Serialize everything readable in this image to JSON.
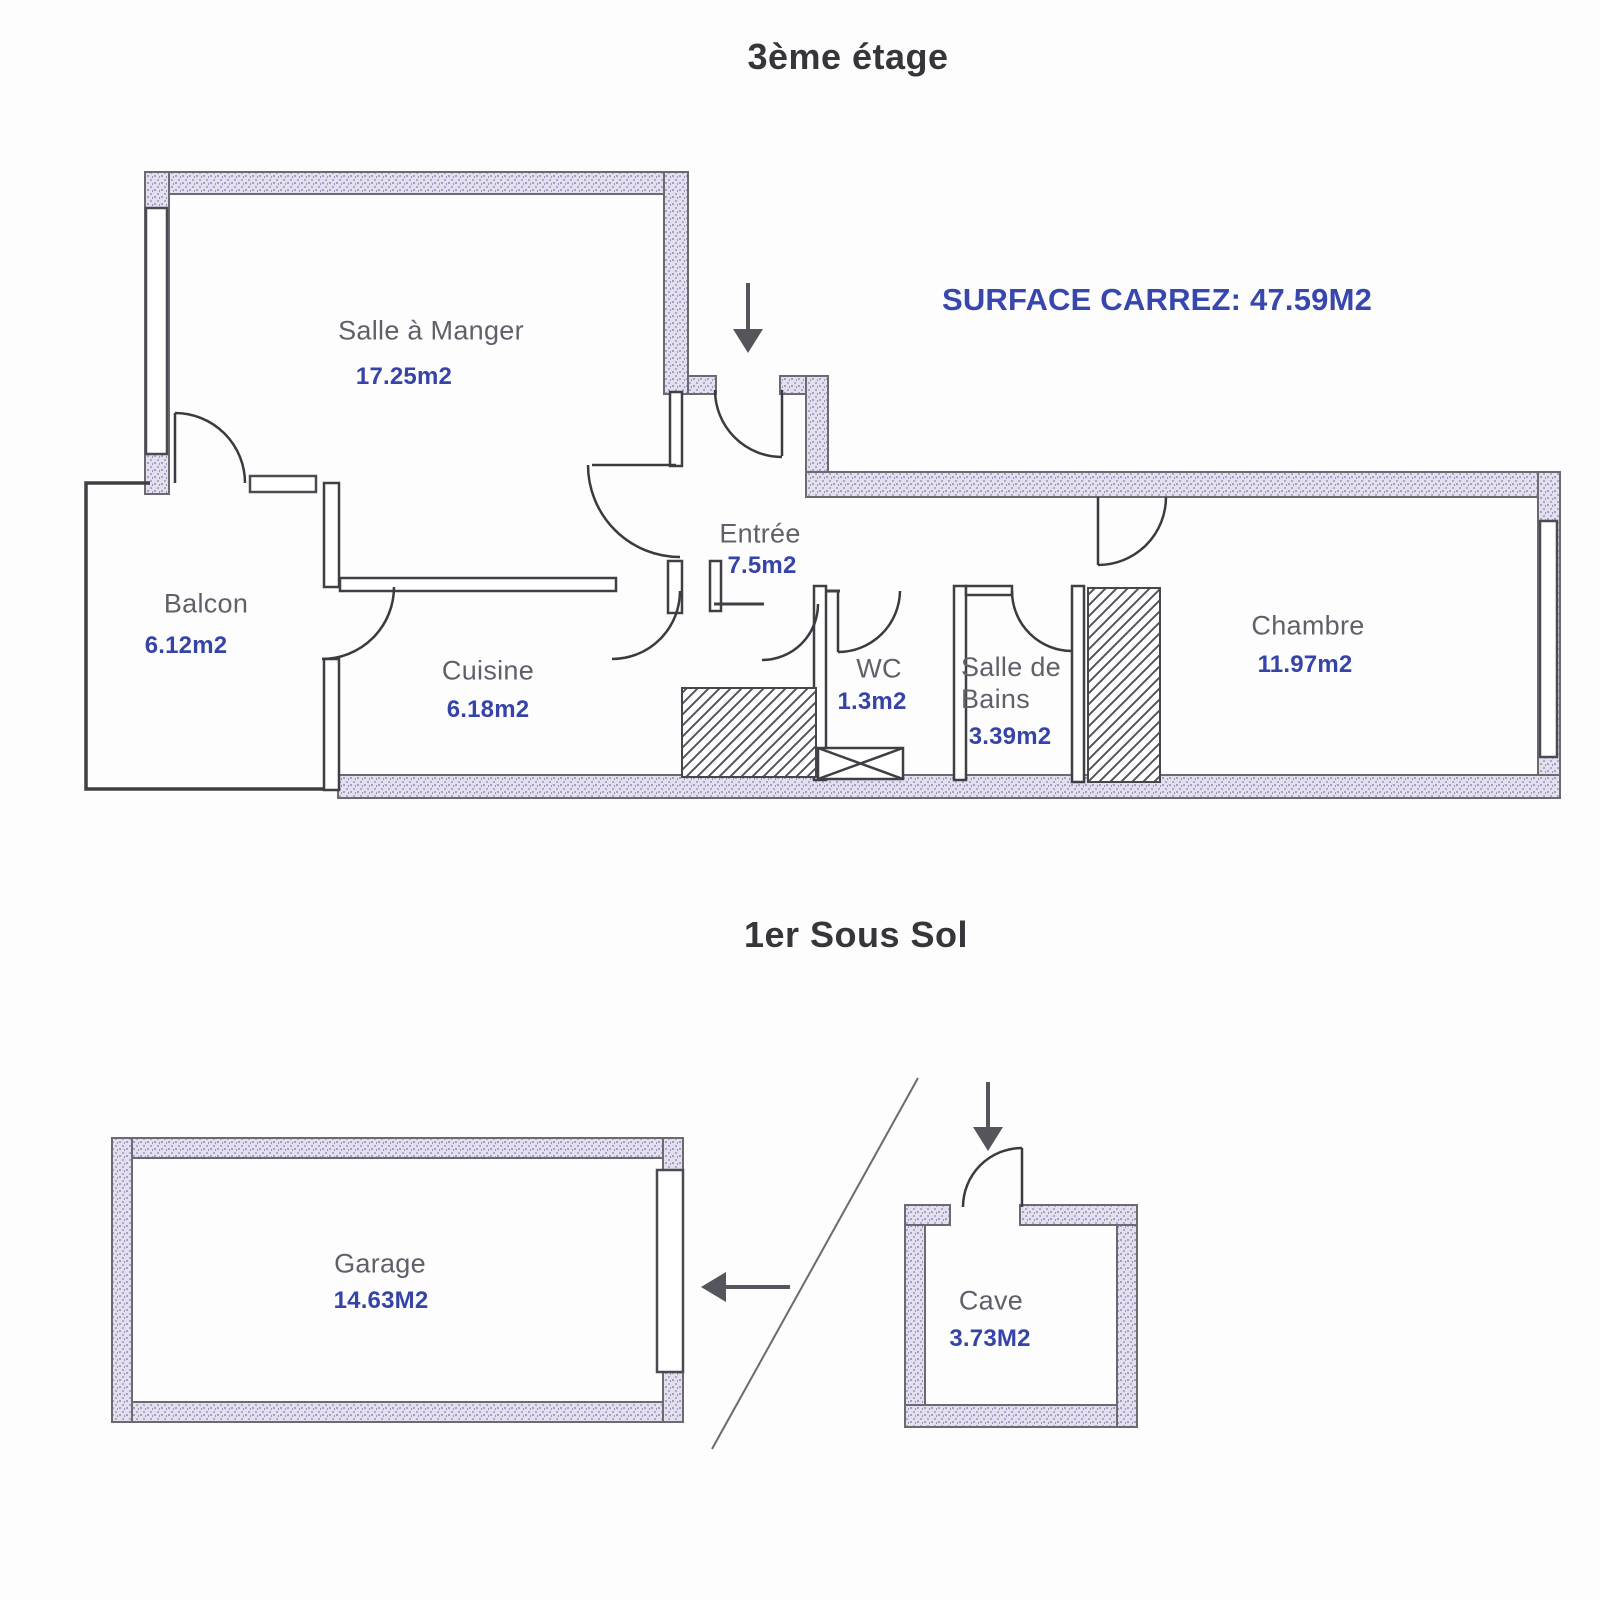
{
  "floor3": {
    "title": "3ème étage",
    "surface_note": "SURFACE CARREZ: 47.59M2",
    "rooms": [
      {
        "id": "salle-a-manger",
        "name": "Salle à Manger",
        "area": "17.25m2"
      },
      {
        "id": "balcon",
        "name": "Balcon",
        "area": "6.12m2"
      },
      {
        "id": "cuisine",
        "name": "Cuisine",
        "area": "6.18m2"
      },
      {
        "id": "entree",
        "name": "Entrée",
        "area": "7.5m2"
      },
      {
        "id": "wc",
        "name": "WC",
        "area": "1.3m2"
      },
      {
        "id": "salle-de-bains",
        "name": "Salle de Bains",
        "area": "3.39m2"
      },
      {
        "id": "chambre",
        "name": "Chambre",
        "area": "11.97m2"
      }
    ]
  },
  "basement": {
    "title": "1er Sous Sol",
    "rooms": [
      {
        "id": "garage",
        "name": "Garage",
        "area": "14.63M2"
      },
      {
        "id": "cave",
        "name": "Cave",
        "area": "3.73M2"
      }
    ]
  },
  "colors": {
    "area_value_blue": "#3644a8",
    "surface_note_blue": "#3747ad",
    "room_label_gray": "#60606a",
    "title_dark": "#35353a",
    "wall_fill_lavender": "#e3dfee"
  }
}
